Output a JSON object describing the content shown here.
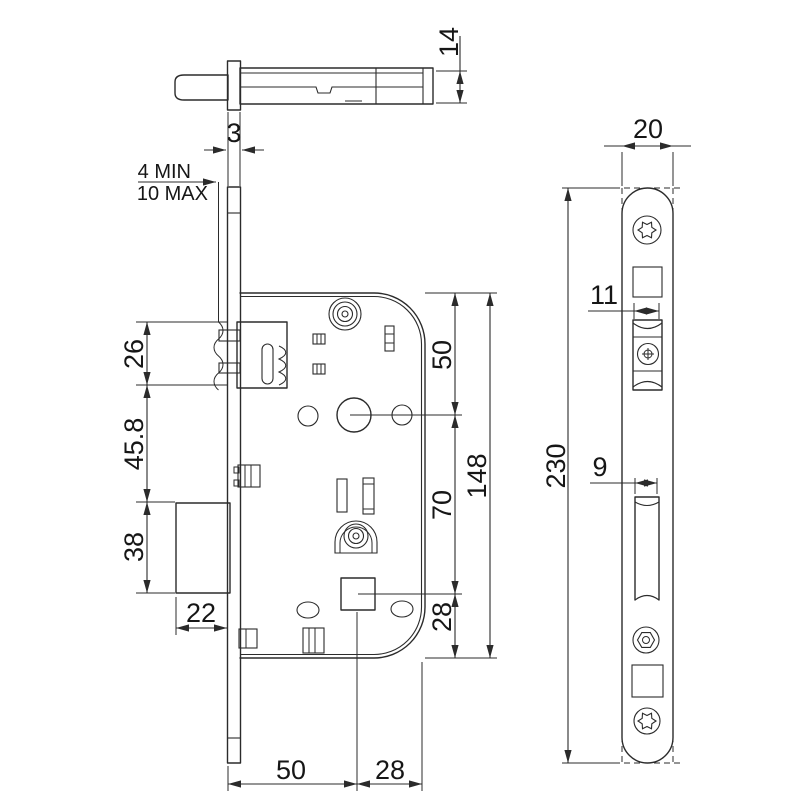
{
  "views": {
    "bolt_top": {
      "dims": {
        "height": "14",
        "faceplate_thickness": "3",
        "recess_min": "4 MIN",
        "recess_max": "10 MAX"
      }
    },
    "case_front": {
      "dims": {
        "latch_zone": "26",
        "mid_zone": "45.8",
        "deadbolt_zone": "38",
        "deadbolt_throw": "22",
        "top_to_handle": "50",
        "handle_to_spindle": "70",
        "spindle_to_bottom": "28",
        "case_height": "148",
        "backset": "50",
        "case_rear_depth": "28"
      }
    },
    "faceplate": {
      "dims": {
        "width": "20",
        "latch_width": "11",
        "deadbolt_width": "9",
        "length": "230"
      }
    }
  },
  "colors": {
    "line": "#2b2b2b",
    "text": "#161616",
    "background": "#ffffff"
  }
}
